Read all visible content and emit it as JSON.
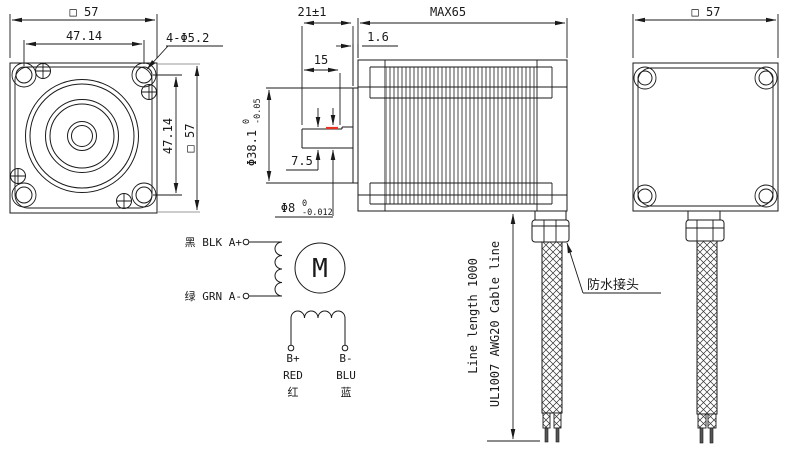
{
  "drawing": {
    "front_view": {
      "top_size": "□ 57",
      "hole_spacing_h": "47.14",
      "holes_label": "4-Φ5.2",
      "hole_spacing_v": "47.14",
      "right_size": "□ 57"
    },
    "side_view": {
      "shaft_length": "21±1",
      "body_length": "MAX65",
      "pilot_height": "1.6",
      "flat_length": "15",
      "pilot_dia": "Φ38.1",
      "pilot_tol_upper": "0",
      "pilot_tol_lower": "-0.05",
      "flat_height": "7.5",
      "shaft_dia": "Φ8",
      "shaft_tol_upper": "0",
      "shaft_tol_lower": "-0.012"
    },
    "rear_view": {
      "top_size": "□ 57"
    },
    "cable": {
      "length_label": "Line length 1000",
      "spec_label": "UL1007 AWG20 Cable line",
      "gland_label": "防水接头"
    },
    "wiring": {
      "phase_a_plus": "黑 BLK A+",
      "phase_a_minus": "绿 GRN A-",
      "motor_letter": "M",
      "b_plus": "B+",
      "b_plus_color": "RED",
      "b_plus_cn": "红",
      "b_minus": "B-",
      "b_minus_color": "BLU",
      "b_minus_cn": "蓝"
    },
    "colors": {
      "line": "#1a1a1a",
      "accent_red": "#e63322",
      "gray": "#999999",
      "background": "#ffffff"
    }
  }
}
